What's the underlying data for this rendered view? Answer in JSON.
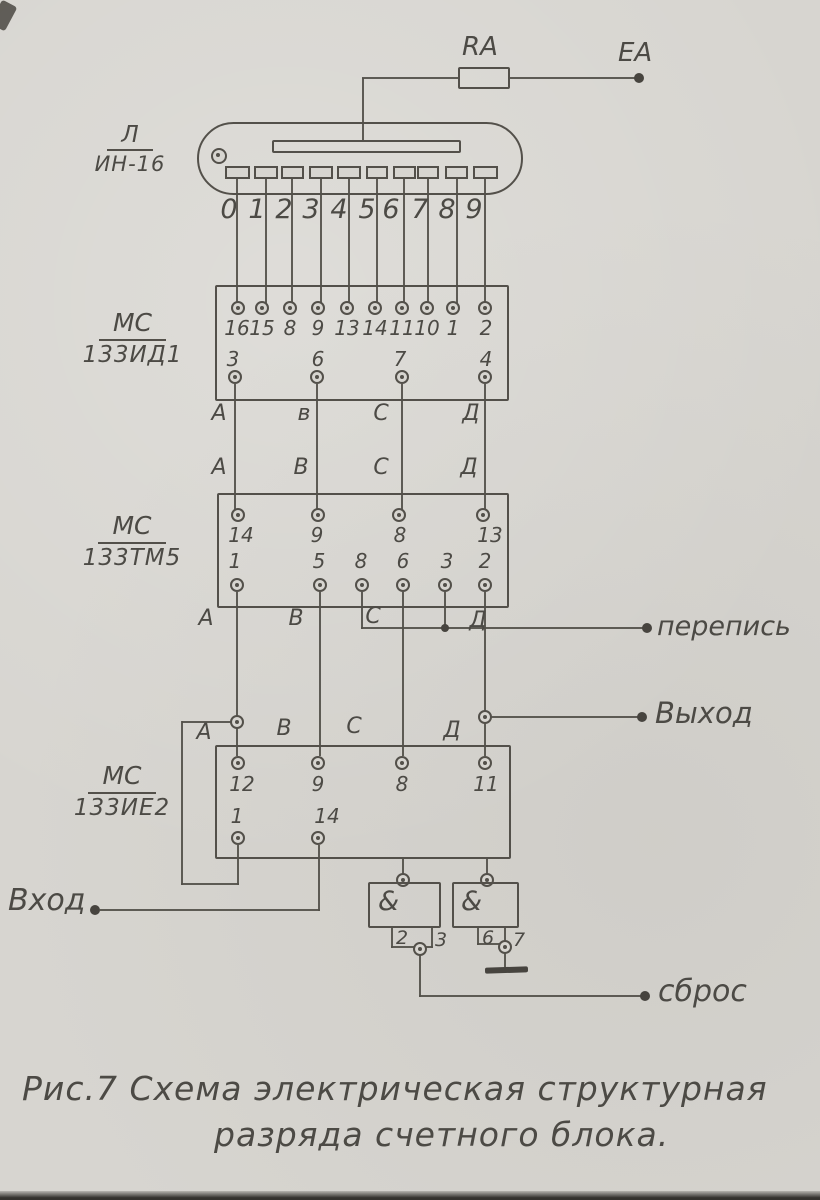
{
  "colors": {
    "ink": "#4c4a45",
    "paper": "#d7d5d0"
  },
  "power": {
    "resistor_label": "RA",
    "anode_terminal": "EA"
  },
  "tube": {
    "name_top": "Л",
    "name_bottom": "ИН-16",
    "digits": [
      "0",
      "1",
      "2",
      "3",
      "4",
      "5",
      "6",
      "7",
      "8",
      "9"
    ]
  },
  "decoder": {
    "name_top": "МС",
    "name_bottom": "133ИД1",
    "top_pins": [
      "16",
      "15",
      "8",
      "9",
      "13",
      "14",
      "11",
      "10",
      "1",
      "2"
    ],
    "bottom_pins": [
      "3",
      "6",
      "7",
      "4"
    ]
  },
  "latch": {
    "name_top": "МС",
    "name_bottom": "133ТМ5",
    "top_pins": [
      "14",
      "9",
      "8",
      "13"
    ],
    "bottom_pins": [
      "1",
      "5",
      "8",
      "6",
      "3",
      "2"
    ]
  },
  "counter": {
    "name_top": "МС",
    "name_bottom": "133ИЕ2",
    "top_pins": [
      "12",
      "9",
      "8",
      "11"
    ],
    "bottom_pins": [
      "1",
      "14"
    ]
  },
  "bus": {
    "row1": [
      "А",
      "в",
      "С",
      "Д"
    ],
    "row2": [
      "А",
      "В",
      "С",
      "Д"
    ],
    "row3": [
      "А",
      "В",
      "С",
      "Д"
    ],
    "row4": [
      "А",
      "В",
      "С",
      "Д"
    ]
  },
  "gates": {
    "left": {
      "symbol": "&",
      "pin_left": "2",
      "pin_right": "3"
    },
    "right": {
      "symbol": "&",
      "pin_left": "6",
      "pin_right": "7"
    }
  },
  "terminals": {
    "perepis": "перепись",
    "vyhod": "Выход",
    "vhod": "Вход",
    "sbros": "сброс"
  },
  "caption": {
    "line1": "Рис.7 Схема электрическая структурная",
    "line2": "разряда счетного блока."
  }
}
